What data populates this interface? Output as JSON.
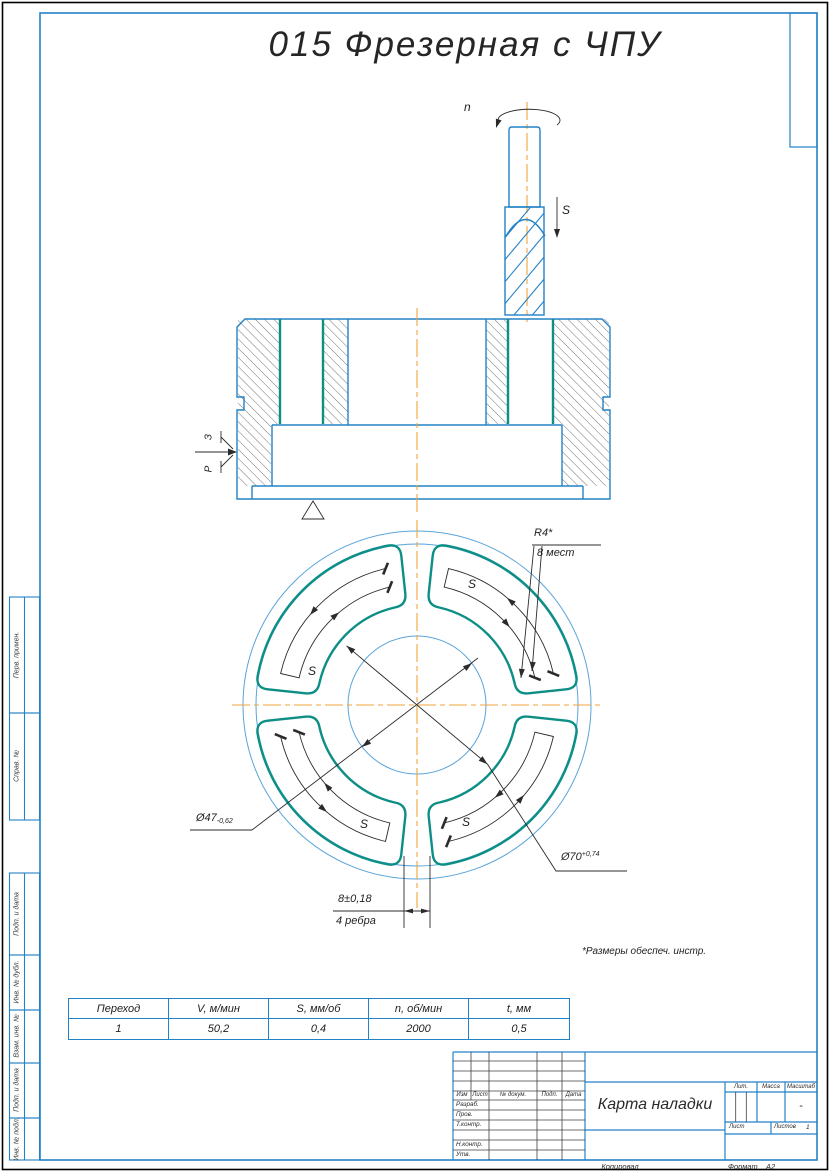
{
  "page": {
    "title": "015 Фрезерная с ЧПУ"
  },
  "colors": {
    "line_blue": "#2382c6",
    "machined_teal": "#0d8f86",
    "centerline_orange": "#f2a43e"
  },
  "tool": {
    "spindle_label": "n",
    "feed_label": "S"
  },
  "clamp": {
    "force_label": "З",
    "reaction_label": "Р"
  },
  "plan": {
    "feed_label": "S",
    "radius_callout_line1": "R4*",
    "radius_callout_line2": "8 мест",
    "dia47_value": "Ø47",
    "dia47_tol": "-0,62",
    "dia70_value": "Ø70",
    "dia70_tol": "+0,74",
    "rib_dim_value": "8±0,18",
    "rib_dim_note": "4 ребра"
  },
  "footnote": "*Размеры обеспеч. инстр.",
  "modes_table": {
    "headers": [
      "Переход",
      "V, м/мин",
      "S, мм/об",
      "n, об/мин",
      "t, мм"
    ],
    "row": [
      "1",
      "50,2",
      "0,4",
      "2000",
      "0,5"
    ]
  },
  "title_block": {
    "doc_name": "Карта наладки",
    "col_izm": "Изм",
    "col_list": "Лист",
    "col_docnum": "№ докум.",
    "col_podp": "Подп.",
    "col_data": "Дата",
    "row_razrab": "Разраб.",
    "row_prov": "Пров.",
    "row_tkontr": "Т.контр.",
    "row_nkontr": "Н.контр.",
    "row_utv": "Утв.",
    "lit_label": "Лит.",
    "massa_label": "Масса",
    "masshtab_label": "Масштаб",
    "masshtab_value": "-",
    "list_label": "Лист",
    "listov_label": "Листов",
    "listov_value": "1",
    "kopiroval": "Копировал",
    "format_label": "Формат",
    "format_value": "А2"
  },
  "margin_labels": {
    "perv_primen": "Перв. примен.",
    "sprav_no": "Справ. №",
    "podp_data_1": "Подп. и дата",
    "inv_dubl": "Инв. № дубл.",
    "vzam_inv": "Взам. инв. №",
    "podp_data_2": "Подп. и дата",
    "inv_podl": "Инв. № подл."
  }
}
